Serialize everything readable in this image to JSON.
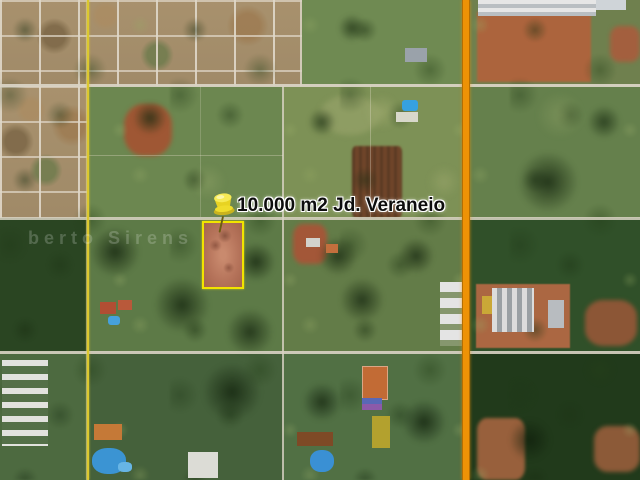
{
  "map": {
    "placemark": {
      "label": "10.000 m2 Jd. Veraneio",
      "icon": "pushpin-icon"
    },
    "watermark_text": "berto Sirens",
    "colors": {
      "parcel_outline": "#f2e400",
      "pushpin": "#efdc2b",
      "highway_overlay_orange": "#ee9206",
      "road_overlay_yellow": "#dcc82f"
    }
  }
}
